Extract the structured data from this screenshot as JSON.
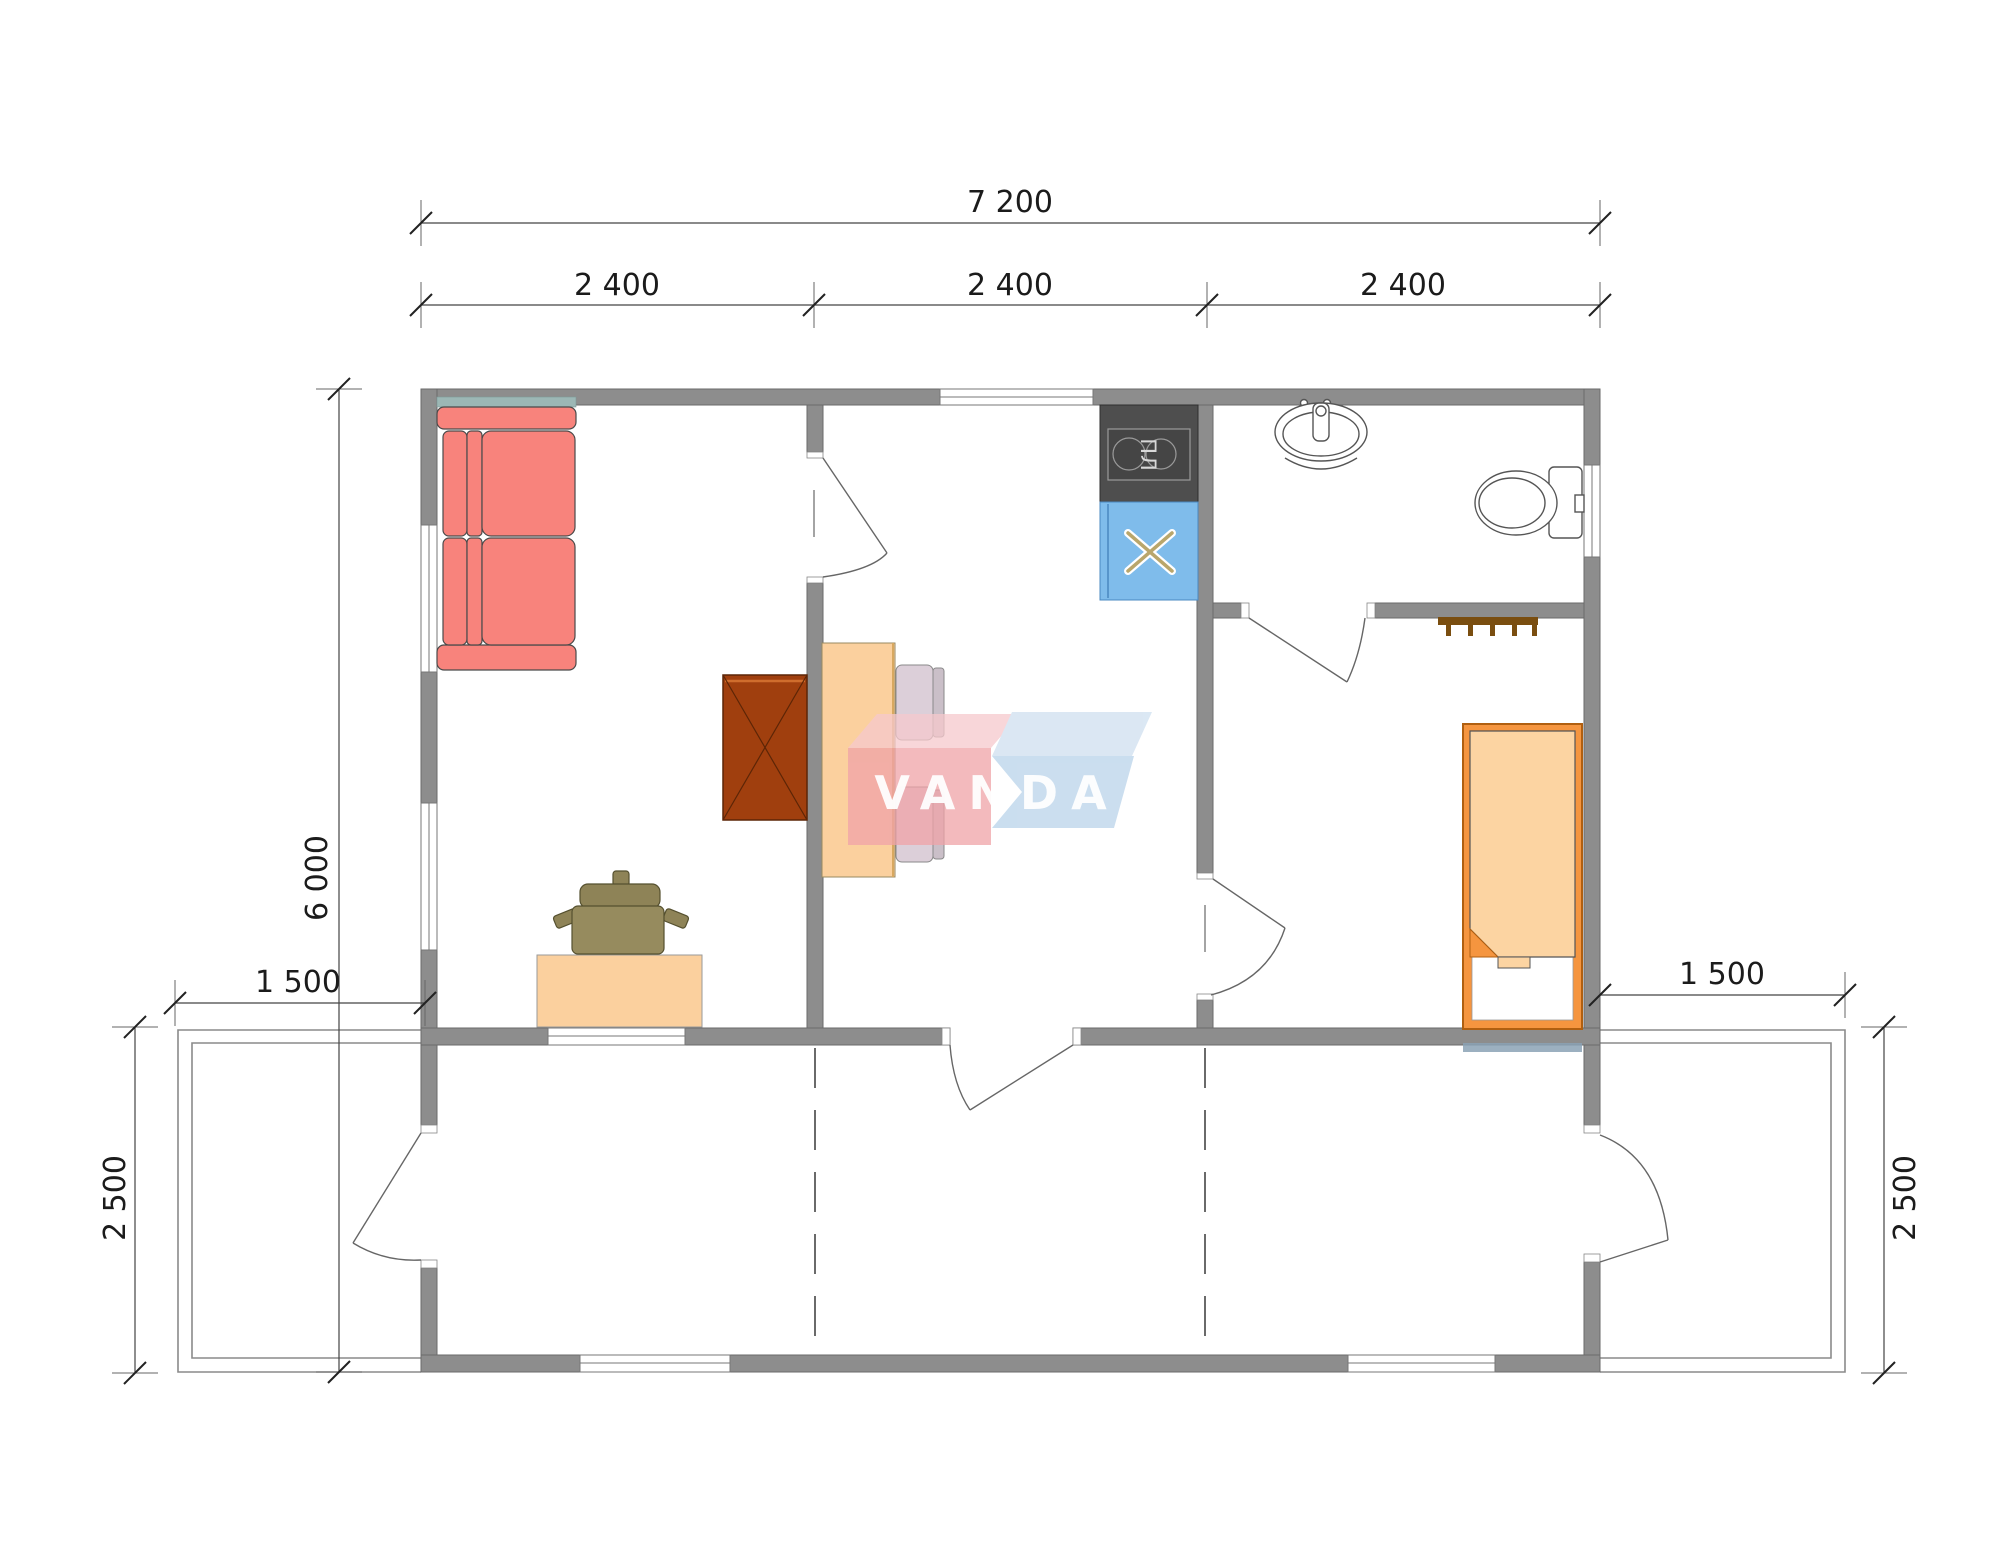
{
  "watermark": {
    "text": "VANDA",
    "pink": "#f0a3a8",
    "blue": "#b9d3ea"
  },
  "labels": {
    "stove_label": "ПЛ"
  },
  "dimensions": {
    "top_total": "7 200",
    "top_segments": [
      "2 400",
      "2 400",
      "2 400"
    ],
    "overall_depth": "6 000",
    "left_porch": {
      "width": "1 500",
      "depth": "2 500"
    },
    "right_porch": {
      "width": "1 500",
      "depth": "2 500"
    }
  },
  "colors": {
    "wall": "#8d8d8d",
    "sofa": "#f8837c",
    "sofa_back": "#9cb7b5",
    "wood_light": "#fbd09e",
    "cabinet_brown": "#a03f0e",
    "dining_chair": "#dccfd9",
    "office_chair": "#8e8357",
    "bed_frame": "#f5953f",
    "bed_blanket": "#fcd4a2",
    "stove_dark": "#4e4e4e",
    "sink_blue": "#7fbceb",
    "coat_rack": "#7a4e10",
    "dimension_text": "#1b1b1b"
  }
}
